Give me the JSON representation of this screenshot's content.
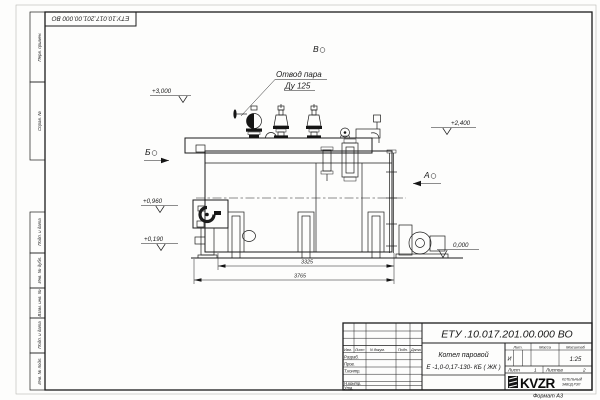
{
  "page": {
    "corner_stamp": "ЕТУ.10.017.201.00.000  ВО",
    "format_note": "Формат  А3"
  },
  "margin_labels": {
    "perv_primen": "Перв. примен.",
    "sprav_no": "Справ. №",
    "podp_data_1": "Подп. и дата",
    "inv_dubl": "Инв. № дубл.",
    "vzam_inv": "Взам. инв. №",
    "podp_data_2": "Подп. и дата",
    "inv_podl": "Инв. № подл."
  },
  "drawing": {
    "annotation_line1": "Отвод пара",
    "annotation_line2": "Ду 125",
    "view_v": "В",
    "view_b": "Б",
    "view_a": "А",
    "elevations": {
      "e3000": "+3,000",
      "e2400": "+2,400",
      "e0960": "+0,960",
      "e0190": "+0,190",
      "e0000": "0,000"
    },
    "dim_3325": "3325",
    "dim_3765": "3765"
  },
  "title_block": {
    "doc_number": "ЕТУ .10.017.201.00.000  ВО",
    "product_name_line1": "Котел паровой",
    "product_name_line2": "Е -1,0-0,17-130- КБ ( ЖК )",
    "headers": {
      "izm": "Изм.",
      "list": "Лист",
      "n_dokum": "N докум.",
      "podp": "Подп.",
      "data": "Дата",
      "lit": "Лит.",
      "massa": "Масса",
      "masshtab": "Масштаб"
    },
    "rows": {
      "razrab": "Разраб.",
      "prov": "Пров.",
      "t_kontr": "Т.контр.",
      "n_kontr": "Н.контр.",
      "utv": "Утв."
    },
    "lit_value": "И",
    "scale": "1:25",
    "sheet_label": "Лист",
    "sheet_value": "1",
    "sheets_label": "Листов",
    "sheets_value": "2",
    "logo": "KVZR",
    "logo_sub1": "КОТЕЛЬНЫЙ",
    "logo_sub2": "ЗАВОД РЭП"
  }
}
